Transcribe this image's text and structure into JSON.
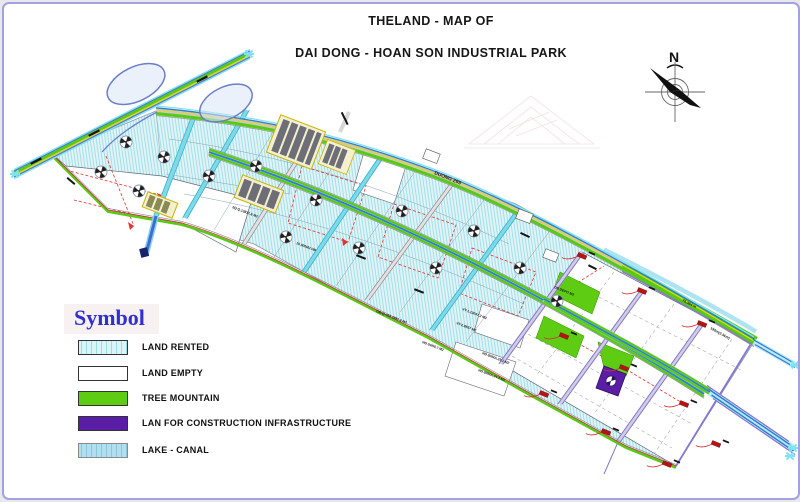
{
  "window": {
    "background": "#ffffff",
    "border_color": "#a2a2e2"
  },
  "title": {
    "line1": "THELAND - MAP OF",
    "line2": "DAI DONG - HOAN SON INDUSTRIAL PARK"
  },
  "compass": {
    "label": "N"
  },
  "legend": {
    "title": "Symbol",
    "items": [
      {
        "label": "LAND RENTED",
        "color": "#daf5f7",
        "pattern": "vertical-hatch-cyan"
      },
      {
        "label": "LAND EMPTY",
        "color": "#ffffff",
        "pattern": "solid"
      },
      {
        "label": "TREE MOUNTAIN",
        "color": "#5ecc12",
        "pattern": "solid"
      },
      {
        "label": "LAN FOR CONSTRUCTION INFRASTRUCTURE",
        "color": "#5a1ea6",
        "pattern": "solid"
      },
      {
        "label": "LAKE - CANAL",
        "color": "#b2dff0",
        "pattern": "vertical-hatch-blue"
      }
    ]
  },
  "map": {
    "road_labels": [
      {
        "text": "DUONG 295"
      },
      {
        "text": "75.384 m"
      },
      {
        "text": "190m(2.5km)"
      }
    ],
    "plot_labels": [
      {
        "text": "2Q-Q.13817.8 M2"
      },
      {
        "text": "10.000M2 HĐ"
      },
      {
        "text": "GĐ-Q-415 2997.3 M2"
      },
      {
        "text": "VT-1.13047.2 M2"
      },
      {
        "text": "VT-2.8537 M2"
      },
      {
        "text": "HD.04/05.7 M2"
      },
      {
        "text": "HD.50/RA.29.1 M2"
      },
      {
        "text": "HD.50/RA.34.3 M2"
      },
      {
        "text": "DB.DEPO M2"
      }
    ],
    "colors": {
      "road_green": "#55cc11",
      "canal_blue": "#2a7fd4",
      "canal_cyan": "#7fe3ef",
      "marker_red": "#b41414",
      "dash_red": "#e23333",
      "purple_road": "#8877cc",
      "infra_purple": "#5a1ea6",
      "highway_loop": "#6b7ec9"
    }
  }
}
